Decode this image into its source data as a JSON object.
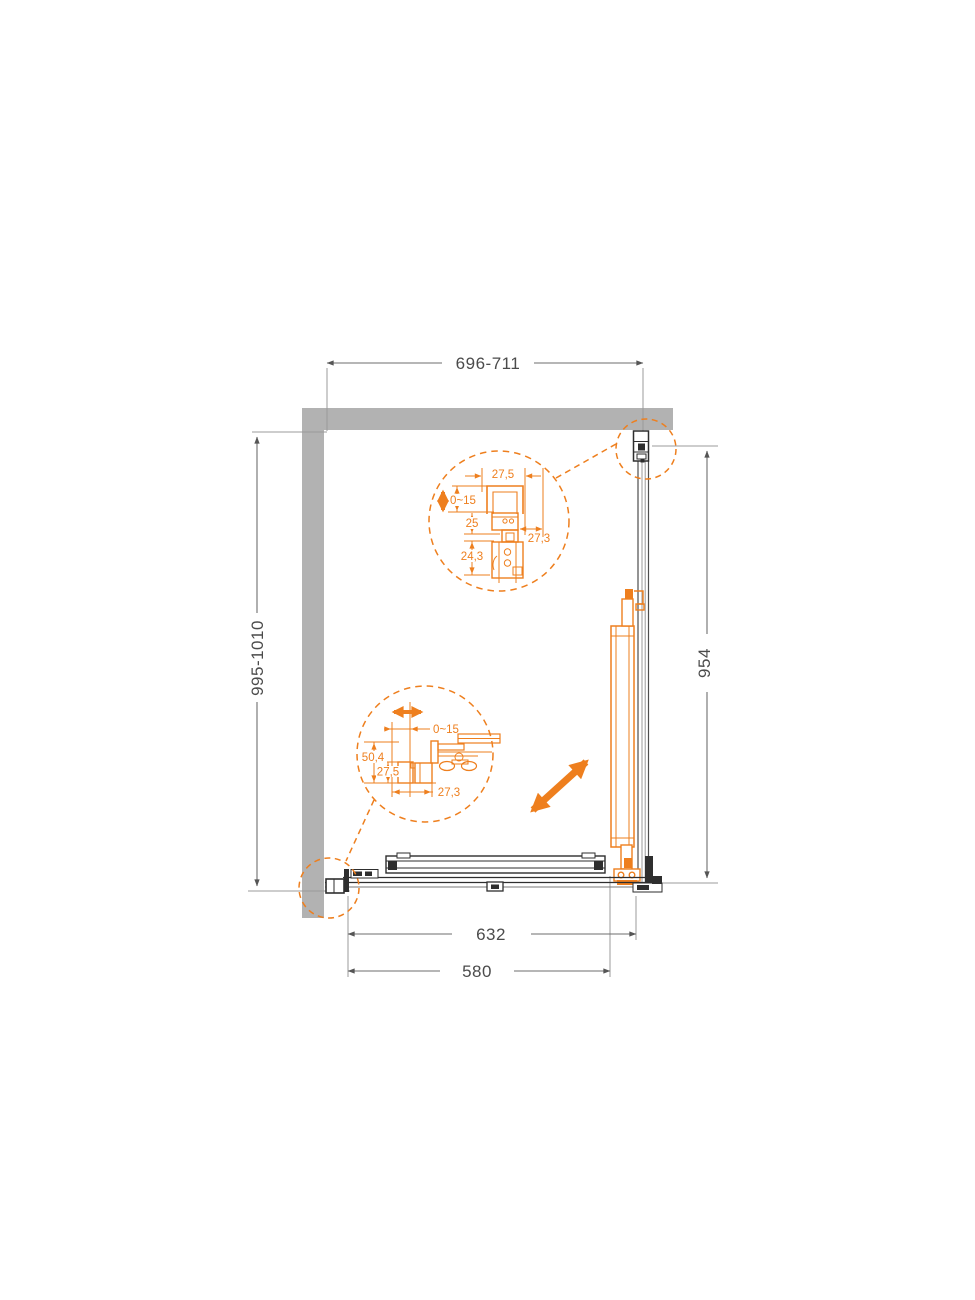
{
  "diagram": {
    "name": "shower-enclosure-technical-plan",
    "colors": {
      "accent_orange": "#EE7F1E",
      "wall_gray": "#B2B2B2",
      "line_dark": "#2E2E2E",
      "dim_gray": "#6E6E6E"
    },
    "dimensions": {
      "top_width_range": "696-711",
      "left_depth_range": "995-1010",
      "side_panel_width": "954",
      "bottom_rail_width": "632",
      "bottom_glass_width": "580"
    },
    "wall_profile_detail": {
      "profile_width": "27,5",
      "adjustment_range": "0~15",
      "inner_width": "25",
      "holder_width": "24,3",
      "profile_depth": "27,3"
    },
    "bottom_profile_detail": {
      "adjustment_range": "0~15",
      "total_depth": "50,4",
      "profile_height": "27,5",
      "profile_depth": "27,3"
    }
  }
}
